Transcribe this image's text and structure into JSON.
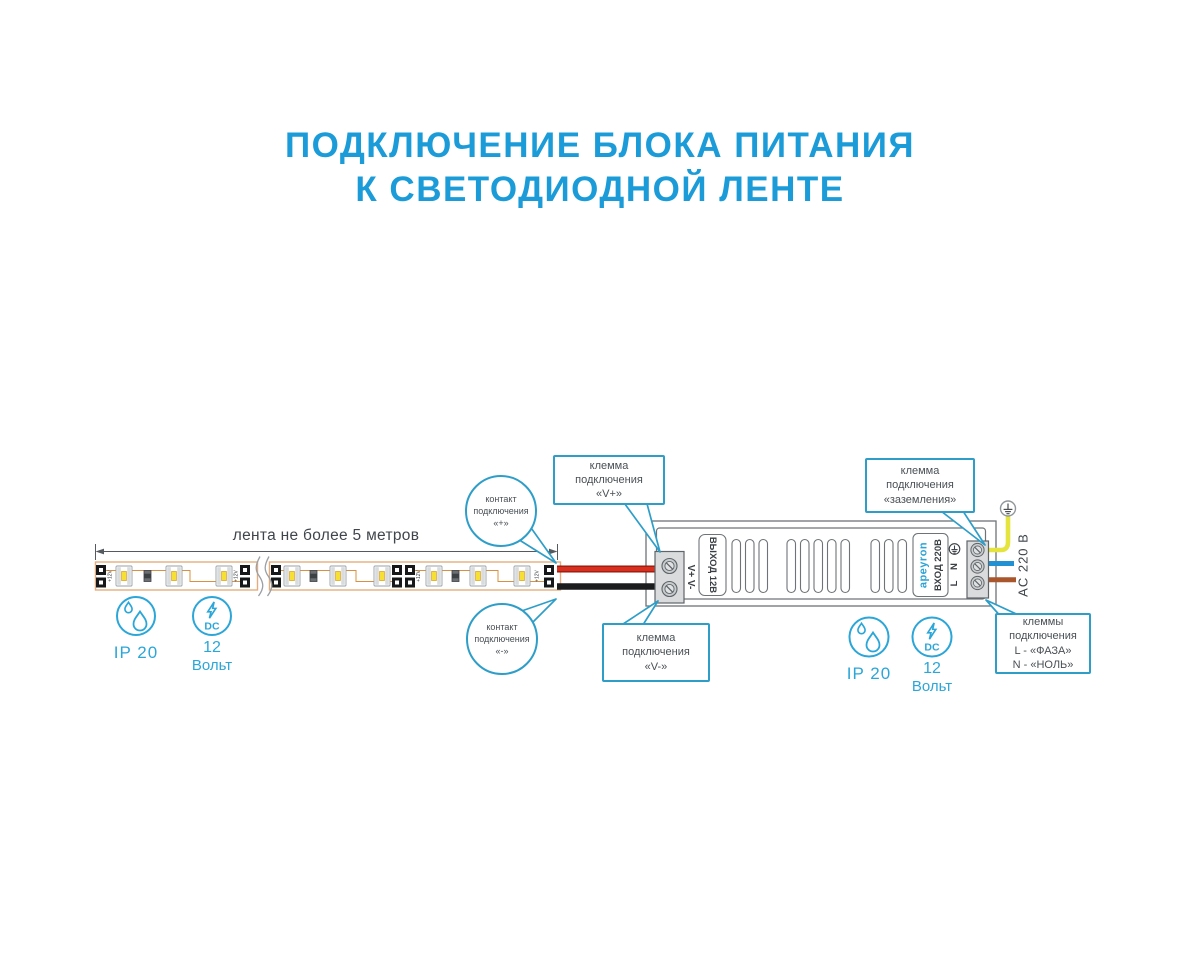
{
  "title": {
    "line1": "ПОДКЛЮЧЕНИЕ БЛОКА ПИТАНИЯ",
    "line2": "К СВЕТОДИОДНОЙ ЛЕНТЕ"
  },
  "strip": {
    "dimension_label": "лента не более 5 метров",
    "pad_label": "+12V"
  },
  "psu": {
    "output_label": "ВЫХОД 12В",
    "output_terminals": "V+ V-",
    "brand": "apeyron",
    "input_label": "ВХОД 220В",
    "terminal_n": "N",
    "terminal_l": "L",
    "ac_label": "AC 220 В"
  },
  "callouts": {
    "contact_plus": {
      "lines": [
        "контакт",
        "подключения",
        "«+»"
      ]
    },
    "contact_minus": {
      "lines": [
        "контакт",
        "подключения",
        "«-»"
      ]
    },
    "terminal_vplus": {
      "lines": [
        "клемма",
        "подключения",
        "«V+»"
      ]
    },
    "terminal_vminus": {
      "lines": [
        "клемма",
        "подключения",
        "«V-»"
      ]
    },
    "terminal_ground": {
      "lines": [
        "клемма",
        "подключения",
        "«заземления»"
      ]
    },
    "terminal_ln": {
      "lines": [
        "клеммы",
        "подключения",
        "L - «ФАЗА»",
        "N - «НОЛЬ»"
      ]
    }
  },
  "badges": {
    "left": {
      "ip": "IP 20",
      "volt_line1": "12",
      "volt_line2": "Вольт",
      "dc": "DC"
    },
    "right": {
      "ip": "IP 20",
      "volt_line1": "12",
      "volt_line2": "Вольт",
      "dc": "DC"
    }
  },
  "icons": {
    "ground": "earth-ground-icon",
    "ip_rating": "water-drops-icon",
    "dc_voltage": "lightning-dc-icon"
  },
  "colors": {
    "accent_blue": "#1b9cd8",
    "callout_blue": "#2e9ec8",
    "icon_blue": "#2ba6d8",
    "wire_red": "#d92f1e",
    "wire_black": "#1b1c1e",
    "wire_yellow": "#e5e33e",
    "wire_blue": "#2191d4",
    "wire_brown": "#a9562c",
    "led_yellow": "#f6e033"
  }
}
